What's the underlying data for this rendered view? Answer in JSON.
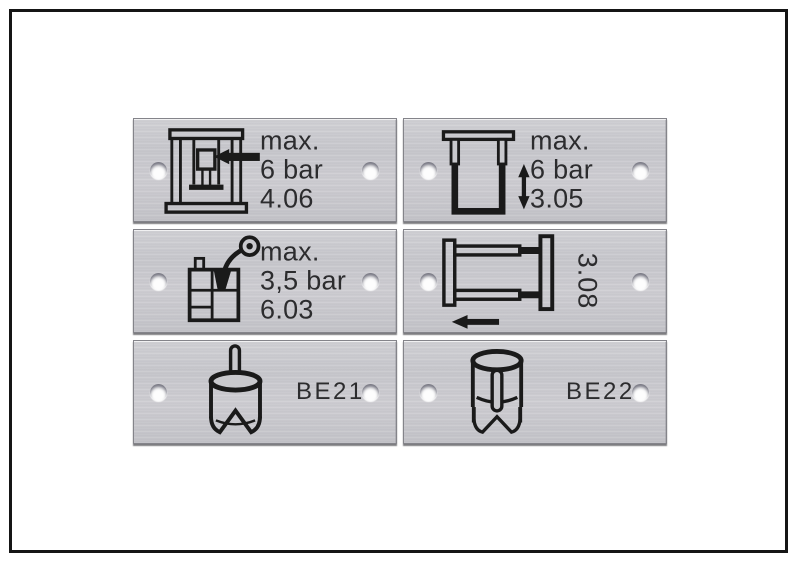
{
  "frame": {
    "border_color": "#151515",
    "background": "#ffffff"
  },
  "plate_style": {
    "metal_color": "#c8c8cc",
    "text_color": "#2c2c2e",
    "icon_color": "#1a1a1a",
    "hole_color": "#fdfdfd"
  },
  "plates": {
    "top_left": {
      "icon": "press-ram-arrow-icon",
      "lines": [
        "max.",
        "6 bar",
        "4.06"
      ]
    },
    "top_right": {
      "icon": "press-stroke-arrow-icon",
      "lines": [
        "max.",
        "6 bar",
        "3.05"
      ]
    },
    "mid_left": {
      "icon": "tank-spray-gauge-icon",
      "lines": [
        "max.",
        "3,5 bar",
        "6.03"
      ]
    },
    "mid_right": {
      "icon": "carriage-left-arrow-icon",
      "rotated_label": "3.08"
    },
    "bottom_left": {
      "icon": "hollow-punch-icon",
      "label": "BE21"
    },
    "bottom_right": {
      "icon": "punch-with-pin-icon",
      "label": "BE22"
    }
  }
}
